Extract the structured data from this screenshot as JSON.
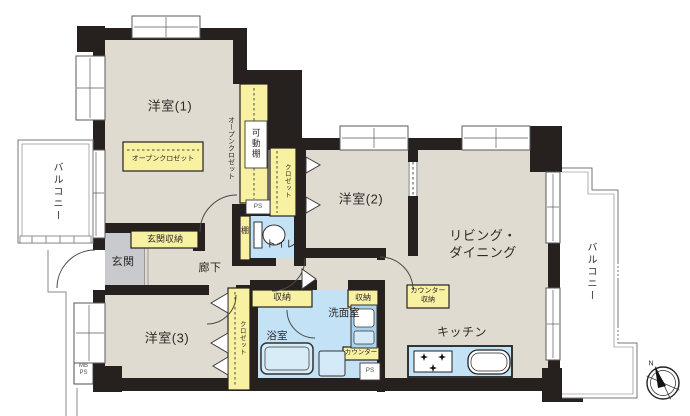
{
  "labels": {
    "room1": "洋室(1)",
    "room2": "洋室(2)",
    "room3": "洋室(3)",
    "living": "リビング・\nダイニング",
    "kitchen": "キッチン",
    "entrance": "玄関",
    "entrance_storage": "玄関収納",
    "hallway": "廊下",
    "toilet": "トイレ",
    "shelf": "棚",
    "movable_shelf": "可動棚",
    "open_closet_side": "オープンクロゼット",
    "open_closet_room1": "オープンクロゼット",
    "closet_room2": "クロゼット",
    "closet_room3": "クロゼット",
    "washroom": "洗面室",
    "bathroom": "浴室",
    "storage_bathside": "収納",
    "storage_washroom": "収納",
    "counter": "カウンター",
    "counter_storage": "カウンター\n収納",
    "balcony_left": "バルコニー",
    "balcony_right": "バルコニー",
    "ps_toilet": "PS",
    "ps_washroom": "PS",
    "meter_box": "MB\nPS",
    "compass_north": "N"
  },
  "colors": {
    "wall": "#26211e",
    "floor": "#e0dbd1",
    "storage_yellow": "#f8f1a2",
    "water_blue": "#c3e2f5",
    "entrance_gray": "#c9cace",
    "fixture_blue": "#d5eaf8"
  }
}
